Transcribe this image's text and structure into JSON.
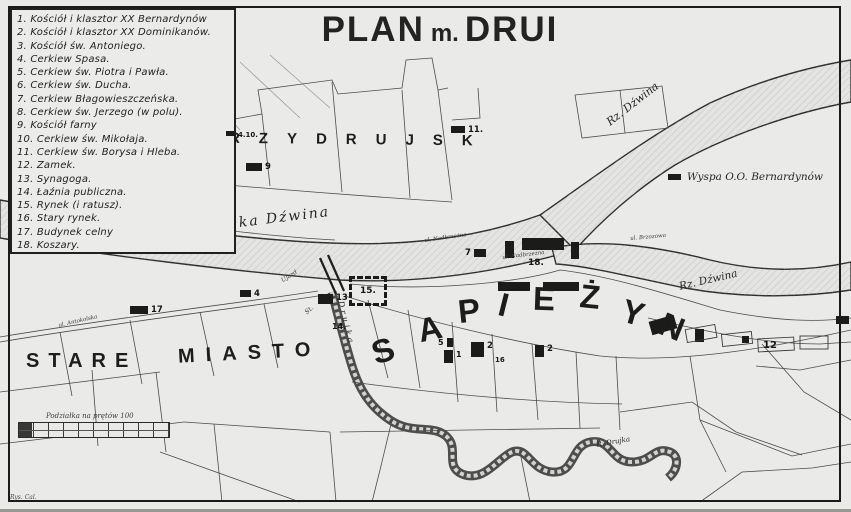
{
  "title": {
    "plan": "PLAN",
    "m": "m.",
    "drui": "DRUI"
  },
  "legend": {
    "items": [
      "1. Kościół i klasztor XX Bernardynów",
      "2. Kościół i klasztor XX Dominikanów.",
      "3. Kościół św. Antoniego.",
      "4. Cerkiew Spasa.",
      "5. Cerkiew św. Piotra i Pawła.",
      "6. Cerkiew św. Ducha.",
      "7. Cerkiew Błagowieszczeńska.",
      "8. Cerkiew św. Jerzego (w polu).",
      "9. Kościół farny",
      "10. Cerkiew św. Mikołaja.",
      "11. Cerkiew św. Borysa i Hleba.",
      "12. Zamek.",
      "13. Synagoga.",
      "14. Łaźnia publiczna.",
      "15. Rynek (i ratusz).",
      "16. Stary rynek.",
      "17. Budynek celny",
      "18. Koszary."
    ]
  },
  "map": {
    "districts": {
      "przydrujsk": "PRZYDRUJSK",
      "stare": "STARE",
      "miasto": "MIASTO"
    },
    "sapiezyn": [
      "S",
      "A",
      "P",
      "I",
      "E",
      "Ż",
      "Y",
      "N"
    ],
    "rivers": {
      "dzwina_top": "Rz. Dźwina",
      "dzwina_main": "Rzeka Dźwina",
      "dzwina_right": "Rz. Dźwina",
      "drujka_vertical": "Drujka",
      "drujka_bend": "R. Drujka"
    },
    "island": {
      "label": "Wyspa O.O. Bernardynów"
    },
    "streets": [
      "ul. Nadbrzeżna",
      "ul. Nadbrzeżna",
      "Ujazd",
      "St.",
      "ul. Antokolska",
      "ul. Brzozowa"
    ],
    "markers": [
      {
        "label": "11."
      },
      {
        "label": "9"
      },
      {
        "label": "4.10."
      },
      {
        "label": "17"
      },
      {
        "label": "7"
      },
      {
        "label": "18."
      },
      {
        "label": "15."
      },
      {
        "label": "13"
      },
      {
        "label": "4"
      },
      {
        "label": "14."
      },
      {
        "label": "5"
      },
      {
        "label": "1"
      },
      {
        "label": "2"
      },
      {
        "label": "16"
      },
      {
        "label": "2"
      },
      {
        "label": "12"
      }
    ]
  },
  "scale": {
    "caption": "Podziałka na prętów 100"
  },
  "signature": "Rys. Cal.",
  "colors": {
    "paper": "#ebebe9",
    "ink": "#1e1e1c",
    "parcel_line": "#4c4c4a",
    "river_fill": "#e4e4e2"
  }
}
